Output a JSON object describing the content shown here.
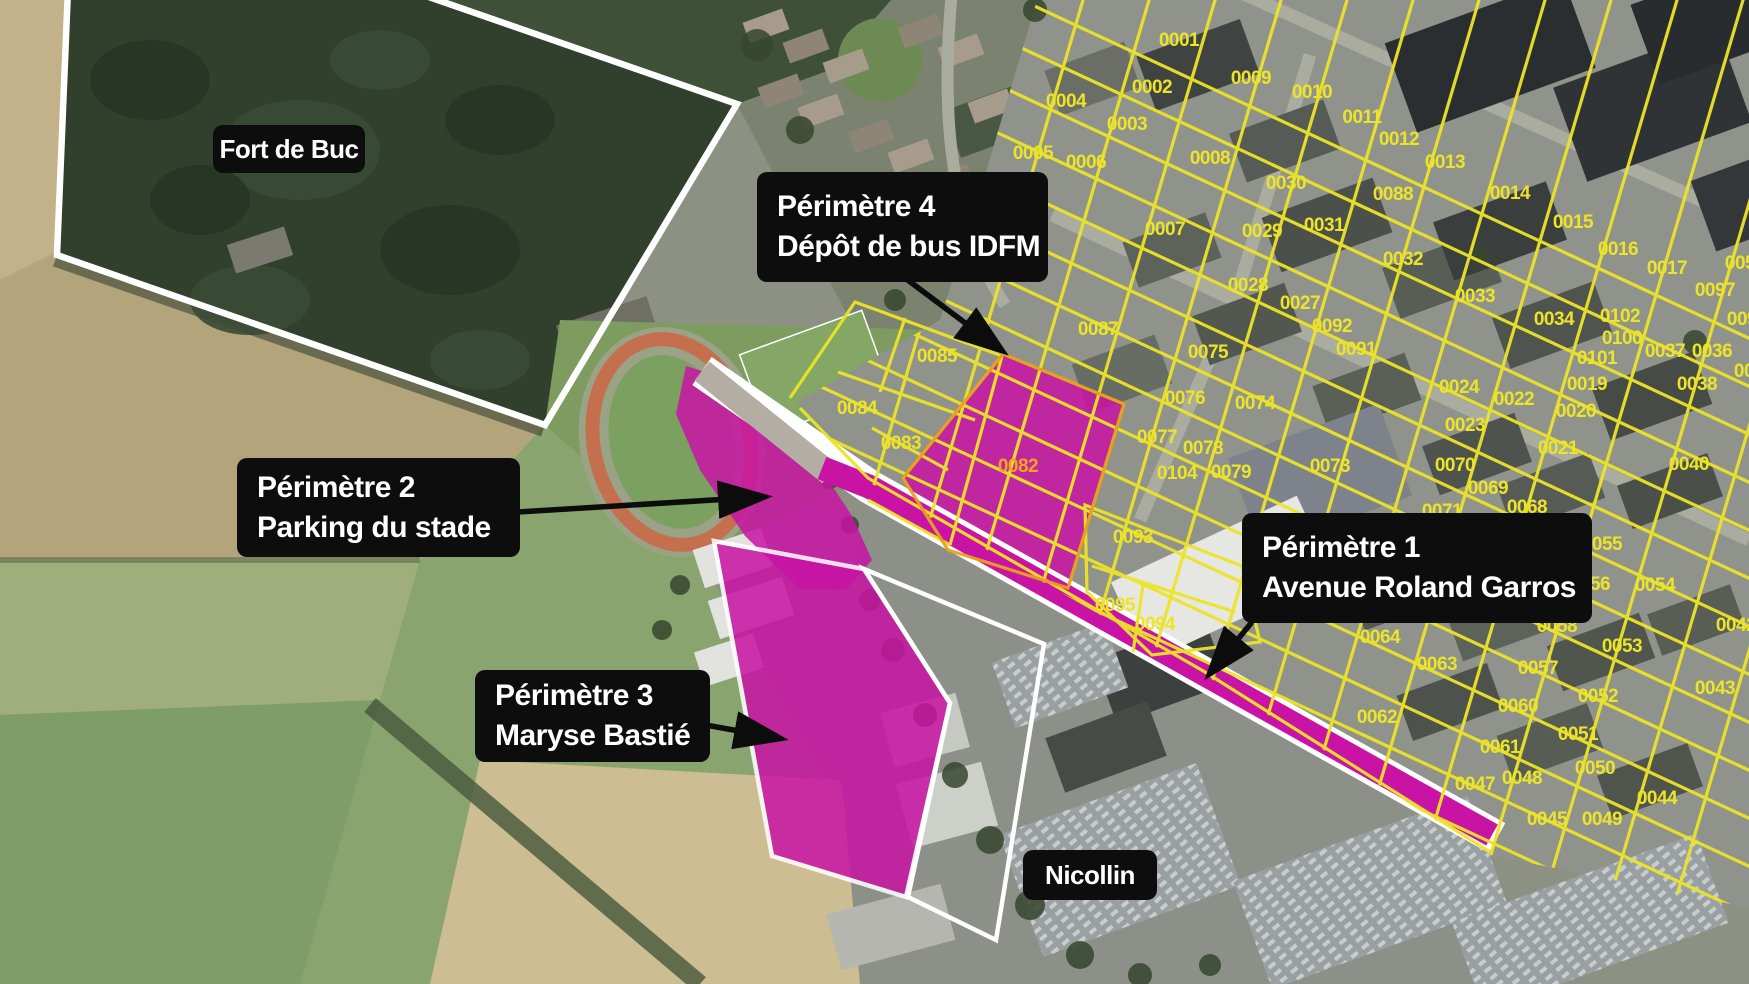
{
  "annotations": {
    "fort": {
      "text": "Fort de Buc"
    },
    "perimetre4": {
      "line1": "Périmètre 4",
      "line2": "Dépôt de bus IDFM"
    },
    "perimetre2": {
      "line1": "Périmètre 2",
      "line2": "Parking du stade"
    },
    "perimetre3": {
      "line1": "Périmètre 3",
      "line2": "Maryse Bastié"
    },
    "perimetre1": {
      "line1": "Périmètre 1",
      "line2": "Avenue Roland Garros"
    },
    "nicollin": {
      "text": "Nicollin"
    }
  },
  "colors": {
    "magenta": "#c913a4",
    "parcelYellow": "#ece428",
    "parcelOrange": "#f0a61b",
    "outlineWhite": "#ffffff",
    "labelBg": "#0d0d0d",
    "labelText": "#ffffff",
    "arrowBlack": "#0c0c0c"
  },
  "parcels": [
    {
      "id": "0001",
      "x": 1179,
      "y": 39
    },
    {
      "id": "0002",
      "x": 1152,
      "y": 86
    },
    {
      "id": "0003",
      "x": 1127,
      "y": 123
    },
    {
      "id": "0004",
      "x": 1066,
      "y": 100
    },
    {
      "id": "0005",
      "x": 1033,
      "y": 152
    },
    {
      "id": "0006",
      "x": 1086,
      "y": 161
    },
    {
      "id": "0007",
      "x": 1165,
      "y": 228
    },
    {
      "id": "0008",
      "x": 1210,
      "y": 157
    },
    {
      "id": "0009",
      "x": 1251,
      "y": 77
    },
    {
      "id": "0010",
      "x": 1312,
      "y": 91
    },
    {
      "id": "0011",
      "x": 1362,
      "y": 116
    },
    {
      "id": "0012",
      "x": 1399,
      "y": 138
    },
    {
      "id": "0013",
      "x": 1445,
      "y": 161
    },
    {
      "id": "0014",
      "x": 1510,
      "y": 192
    },
    {
      "id": "0015",
      "x": 1573,
      "y": 221
    },
    {
      "id": "0016",
      "x": 1618,
      "y": 248
    },
    {
      "id": "0017",
      "x": 1667,
      "y": 267
    },
    {
      "id": "0088",
      "x": 1393,
      "y": 193
    },
    {
      "id": "0030",
      "x": 1286,
      "y": 182
    },
    {
      "id": "0029",
      "x": 1262,
      "y": 230
    },
    {
      "id": "0031",
      "x": 1324,
      "y": 224
    },
    {
      "id": "0028",
      "x": 1248,
      "y": 284
    },
    {
      "id": "0027",
      "x": 1300,
      "y": 302
    },
    {
      "id": "0092",
      "x": 1332,
      "y": 325
    },
    {
      "id": "0091",
      "x": 1356,
      "y": 348
    },
    {
      "id": "0032",
      "x": 1403,
      "y": 258
    },
    {
      "id": "0033",
      "x": 1475,
      "y": 295
    },
    {
      "id": "0034",
      "x": 1554,
      "y": 318
    },
    {
      "id": "0102",
      "x": 1620,
      "y": 315
    },
    {
      "id": "0100",
      "x": 1622,
      "y": 337
    },
    {
      "id": "0101",
      "x": 1597,
      "y": 357
    },
    {
      "id": "0097",
      "x": 1715,
      "y": 289
    },
    {
      "id": "005",
      "x": 1740,
      "y": 262
    },
    {
      "id": "009",
      "x": 1742,
      "y": 318
    },
    {
      "id": "00",
      "x": 1744,
      "y": 370
    },
    {
      "id": "0037",
      "x": 1665,
      "y": 350
    },
    {
      "id": "0036",
      "x": 1712,
      "y": 350
    },
    {
      "id": "0038",
      "x": 1697,
      "y": 383
    },
    {
      "id": "0024",
      "x": 1459,
      "y": 386
    },
    {
      "id": "0022",
      "x": 1514,
      "y": 398
    },
    {
      "id": "0023",
      "x": 1465,
      "y": 424
    },
    {
      "id": "0019",
      "x": 1587,
      "y": 383
    },
    {
      "id": "0020",
      "x": 1576,
      "y": 410
    },
    {
      "id": "0021",
      "x": 1558,
      "y": 447
    },
    {
      "id": "0075",
      "x": 1208,
      "y": 351
    },
    {
      "id": "0076",
      "x": 1185,
      "y": 397
    },
    {
      "id": "0074",
      "x": 1255,
      "y": 402
    },
    {
      "id": "0077",
      "x": 1157,
      "y": 436
    },
    {
      "id": "0078",
      "x": 1203,
      "y": 447
    },
    {
      "id": "0104",
      "x": 1177,
      "y": 472
    },
    {
      "id": "0079",
      "x": 1231,
      "y": 471
    },
    {
      "id": "0087",
      "x": 1098,
      "y": 328
    },
    {
      "id": "0085",
      "x": 937,
      "y": 355
    },
    {
      "id": "0084",
      "x": 857,
      "y": 407
    },
    {
      "id": "0083",
      "x": 901,
      "y": 442
    },
    {
      "id": "0082",
      "x": 1018,
      "y": 465,
      "c": "orange"
    },
    {
      "id": "0073",
      "x": 1330,
      "y": 465
    },
    {
      "id": "0093",
      "x": 1133,
      "y": 536
    },
    {
      "id": "0095",
      "x": 1115,
      "y": 604
    },
    {
      "id": "0094",
      "x": 1155,
      "y": 623
    },
    {
      "id": "0070",
      "x": 1455,
      "y": 464
    },
    {
      "id": "0071",
      "x": 1442,
      "y": 510
    },
    {
      "id": "0069",
      "x": 1488,
      "y": 487
    },
    {
      "id": "0068",
      "x": 1527,
      "y": 506
    },
    {
      "id": "0055",
      "x": 1602,
      "y": 543
    },
    {
      "id": "0054",
      "x": 1655,
      "y": 584
    },
    {
      "id": "0056",
      "x": 1590,
      "y": 583
    },
    {
      "id": "0058",
      "x": 1557,
      "y": 625
    },
    {
      "id": "0053",
      "x": 1622,
      "y": 645
    },
    {
      "id": "0057",
      "x": 1538,
      "y": 667
    },
    {
      "id": "0052",
      "x": 1598,
      "y": 695
    },
    {
      "id": "0051",
      "x": 1578,
      "y": 733
    },
    {
      "id": "0050",
      "x": 1595,
      "y": 767
    },
    {
      "id": "0060",
      "x": 1518,
      "y": 705
    },
    {
      "id": "0061",
      "x": 1500,
      "y": 746
    },
    {
      "id": "0047",
      "x": 1475,
      "y": 783
    },
    {
      "id": "0048",
      "x": 1522,
      "y": 777
    },
    {
      "id": "0045",
      "x": 1547,
      "y": 818
    },
    {
      "id": "0049",
      "x": 1602,
      "y": 818
    },
    {
      "id": "0044",
      "x": 1657,
      "y": 797
    },
    {
      "id": "0043",
      "x": 1715,
      "y": 687
    },
    {
      "id": "0042",
      "x": 1736,
      "y": 624
    },
    {
      "id": "0040",
      "x": 1689,
      "y": 463
    },
    {
      "id": "0062",
      "x": 1377,
      "y": 716
    },
    {
      "id": "0063",
      "x": 1437,
      "y": 663
    },
    {
      "id": "0064",
      "x": 1380,
      "y": 636
    }
  ]
}
